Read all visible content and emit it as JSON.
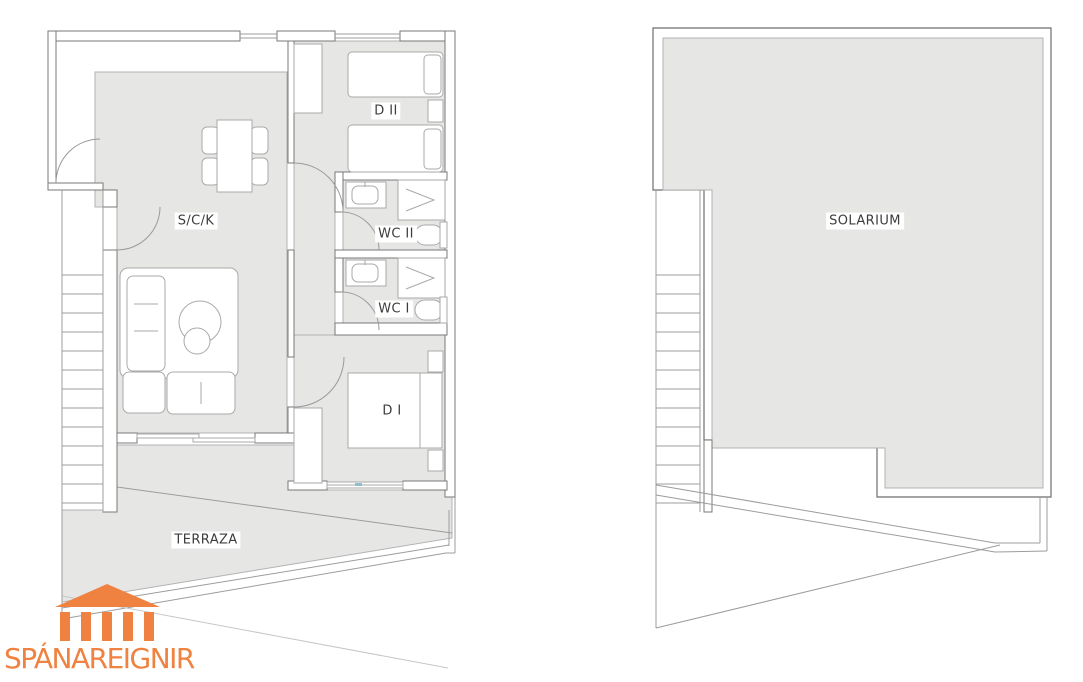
{
  "palette": {
    "floor_fill": "#e6e6e5",
    "wall_line": "#6e6e6e",
    "furniture_line": "#a9a9a9",
    "label_text": "#3c3c3c",
    "label_background": "#ffffff",
    "window_accent_teal": "#8fc0ca",
    "brand_orange": "#ef8240"
  },
  "floorplans": {
    "apartment": {
      "labels": {
        "living_kitchen": "S/C/K",
        "bedroom_2": "D II",
        "bathroom_2": "WC II",
        "bathroom_1": "WC I",
        "bedroom_1": "D I",
        "terrace": "TERRAZA"
      }
    },
    "roof": {
      "labels": {
        "solarium": "SOLARIUM"
      }
    }
  },
  "logo": {
    "brand": "SPÁNAREIGNIR",
    "icon": "temple-columns-icon"
  }
}
